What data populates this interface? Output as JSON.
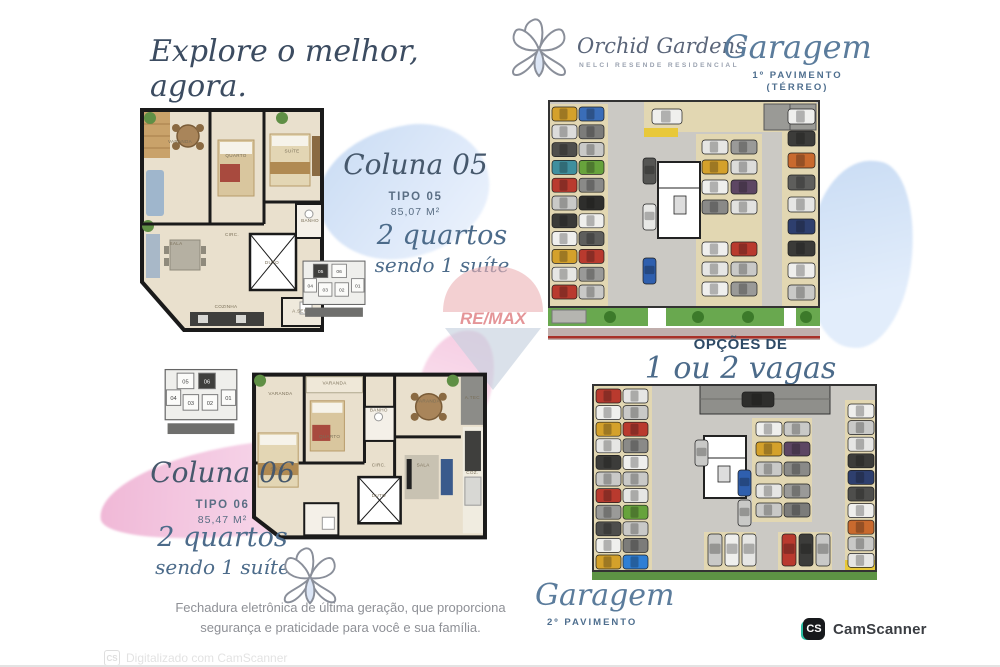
{
  "tagline": "Explore o melhor, agora.",
  "logo": {
    "brand": "Orchid Gardens",
    "subtitle": "NELCI RESENDE RESIDENCIAL"
  },
  "garage_top": {
    "title": "Garagem",
    "line1": "1º PAVIMENTO",
    "line2": "(TÉRREO)"
  },
  "garage_bottom": {
    "title": "Garagem",
    "line1": "2º PAVIMENTO"
  },
  "options": {
    "small": "OPÇÕES DE",
    "big": "1 ou 2 vagas"
  },
  "coluna05": {
    "title": "Coluna 05",
    "tipo": "TIPO 05",
    "area": "85,07 M²",
    "feature1": "2 quartos",
    "feature2": "sendo 1 suíte"
  },
  "coluna06": {
    "title": "Coluna 06",
    "tipo": "TIPO 06",
    "area": "85,47 M²",
    "feature1": "2 quartos",
    "feature2": "sendo 1 suíte"
  },
  "footer": {
    "line1": "Fechadura eletrônica de última geração, que proporciona",
    "line2": "segurança e praticidade para você e sua família."
  },
  "watermark": {
    "brand": "RE/MAX"
  },
  "camscanner": {
    "badge": "CS",
    "label": "CamScanner",
    "watermark": "Digitalizado com CamScanner"
  },
  "keyplan": {
    "units": [
      "05",
      "06",
      "04",
      "01",
      "03",
      "02"
    ],
    "highlight_plan05": "05",
    "highlight_plan06": "06"
  },
  "floorplan05": {
    "rooms": [
      {
        "t": "VARANDA",
        "x": 24,
        "y": 16
      },
      {
        "t": "QUARTO",
        "x": 52,
        "y": 22
      },
      {
        "t": "SUÍTE",
        "x": 80,
        "y": 20
      },
      {
        "t": "SALA",
        "x": 22,
        "y": 60
      },
      {
        "t": "CIRC.",
        "x": 50,
        "y": 56
      },
      {
        "t": "BANHO",
        "x": 89,
        "y": 50
      },
      {
        "t": "DUTO",
        "x": 70,
        "y": 68
      },
      {
        "t": "COZINHA",
        "x": 47,
        "y": 87
      },
      {
        "t": "A.SERV.",
        "x": 85,
        "y": 89
      }
    ]
  },
  "floorplan06": {
    "rooms": [
      {
        "t": "VARANDA",
        "x": 14,
        "y": 16
      },
      {
        "t": "VARANDA",
        "x": 36,
        "y": 10
      },
      {
        "t": "QUARTO",
        "x": 34,
        "y": 40
      },
      {
        "t": "BANHO",
        "x": 54,
        "y": 25
      },
      {
        "t": "VARANDA",
        "x": 74,
        "y": 20
      },
      {
        "t": "SALA",
        "x": 72,
        "y": 56
      },
      {
        "t": "SUÍTE",
        "x": 13,
        "y": 58
      },
      {
        "t": "CIRC.",
        "x": 54,
        "y": 56
      },
      {
        "t": "DUTO",
        "x": 54,
        "y": 73
      },
      {
        "t": "A.TEC",
        "x": 92,
        "y": 18
      },
      {
        "t": "COZ.",
        "x": 92,
        "y": 60
      }
    ]
  },
  "garage1_cars": {
    "left_outer": [
      "#d4a12b",
      "#dcdcda",
      "#4e4e4c",
      "#3f8f9e",
      "#b93a2e",
      "#c9c9c7",
      "#3a3a38",
      "#efefed",
      "#d4a12b",
      "#e6e6e4",
      "#b93a2e"
    ],
    "left_inner": [
      "#3a6db8",
      "#7c7c7a",
      "#c9c9c7",
      "#67a33c",
      "#8a8a88",
      "#2e2e2c",
      "#efefed",
      "#5e5e5c",
      "#b93a2e",
      "#9a9a98",
      "#c9c9c7"
    ],
    "verticals": [
      "#555553",
      "#e8e8e6",
      "#2f5fae"
    ],
    "mid_top": [
      "#efefed"
    ],
    "mid_pairs": [
      [
        "#e6e6e4",
        "#9a9a98"
      ],
      [
        "#d4a12b",
        "#dcdcda"
      ],
      [
        "#efefed",
        "#5d4663"
      ],
      [
        "#8a8a88",
        "#e2e2e0"
      ]
    ],
    "low_pairs": [
      [
        "#efefed",
        "#b93a2e"
      ],
      [
        "#e6e6e4",
        "#c9c9c7"
      ],
      [
        "#efefed",
        "#9a9a98"
      ]
    ],
    "right_col": [
      "#efefed",
      "#3c3c3a",
      "#c96a2e",
      "#5e5e5c",
      "#e6e6e4",
      "#2e3f6e",
      "#3a3a38",
      "#efefed",
      "#c9c9c7"
    ]
  },
  "garage2_cars": {
    "left_outer": [
      "#b93a2e",
      "#efefed",
      "#d4a12b",
      "#e6e6e4",
      "#3c3c3a",
      "#c9c9c7",
      "#b93a2e",
      "#9a9a98",
      "#4e4e4c",
      "#efefed",
      "#d4a12b"
    ],
    "left_inner": [
      "#e6e6e4",
      "#c9c9c7",
      "#b93a2e",
      "#8a8a88",
      "#efefed",
      "#c9c9c7",
      "#e6e6e4",
      "#67a33c",
      "#c9c9c7",
      "#7c7c7a",
      "#2f7fd4"
    ],
    "right_col": [
      "#efefed",
      "#c9c9c7",
      "#e6e6e4",
      "#3c3c3a",
      "#2e3f6e",
      "#4e4e4c",
      "#efefed",
      "#c96a2e",
      "#c9c9c7",
      "#e6e6e4"
    ],
    "ramp_car": [
      "#2e2e2c"
    ],
    "mid_pairs": [
      [
        "#efefed",
        "#c9c9c7"
      ],
      [
        "#d4a12b",
        "#5d4663"
      ],
      [
        "#c9c9c7",
        "#8a8a88"
      ]
    ],
    "mid_lower": [
      [
        "#e6e6e4",
        "#9a9a98"
      ],
      [
        "#c9c9c7",
        "#7c7c7a"
      ]
    ],
    "vertical_blue": [
      "#2f5fae",
      "#c9c9c7"
    ],
    "core_side": [
      "#c9c9c7"
    ],
    "bottom_left_group": [
      "#c9c9c7",
      "#efefed",
      "#e6e6e4"
    ],
    "bottom_right_group": [
      "#b93a2e",
      "#3c3c3a",
      "#c9c9c7"
    ]
  }
}
